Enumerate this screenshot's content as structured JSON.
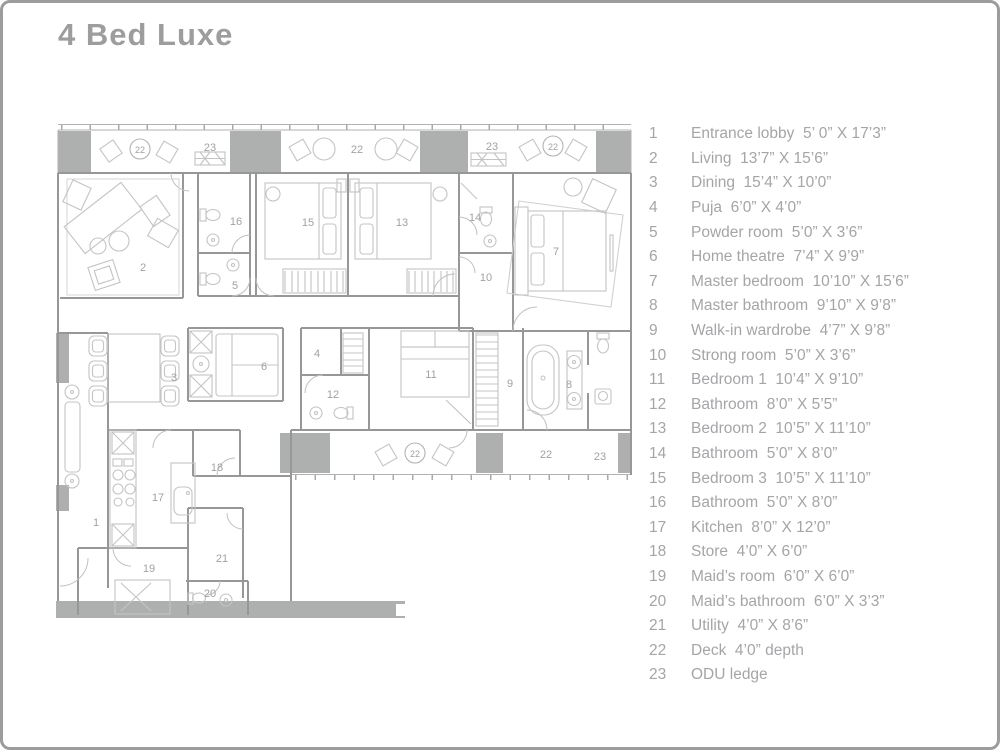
{
  "title": "4 Bed Luxe",
  "colors": {
    "title_gray": "#9d9d9d",
    "legend_text_gray": "#a5a5a8",
    "wall_gray": "#979797",
    "furniture_gray": "#c4c4c4",
    "dark_block_gray": "#aeb0b0",
    "border_gray": "#9c9c9c"
  },
  "legend": {
    "items": [
      {
        "num": "1",
        "label": "Entrance lobby  5’ 0” X 17’3”"
      },
      {
        "num": "2",
        "label": "Living  13’7” X 15’6”"
      },
      {
        "num": "3",
        "label": "Dining  15’4” X 10’0”"
      },
      {
        "num": "4",
        "label": "Puja  6’0” X 4’0”"
      },
      {
        "num": "5",
        "label": "Powder room  5’0” X 3’6”"
      },
      {
        "num": "6",
        "label": "Home theatre  7’4” X 9’9”"
      },
      {
        "num": "7",
        "label": "Master bedroom  10’10” X 15’6”"
      },
      {
        "num": "8",
        "label": "Master bathroom  9’10” X 9’8”"
      },
      {
        "num": "9",
        "label": "Walk-in wardrobe  4’7” X 9’8”"
      },
      {
        "num": "10",
        "label": "Strong room  5’0” X 3’6”"
      },
      {
        "num": "11",
        "label": "Bedroom 1  10’4” X 9’10”"
      },
      {
        "num": "12",
        "label": "Bathroom  8’0” X 5’5”"
      },
      {
        "num": "13",
        "label": "Bedroom 2  10’5” X 11’10”"
      },
      {
        "num": "14",
        "label": "Bathroom  5’0” X 8’0”"
      },
      {
        "num": "15",
        "label": "Bedroom 3  10’5” X 11’10”"
      },
      {
        "num": "16",
        "label": "Bathroom  5’0” X 8’0”"
      },
      {
        "num": "17",
        "label": "Kitchen  8’0” X 12’0”"
      },
      {
        "num": "18",
        "label": "Store  4’0” X 6’0”"
      },
      {
        "num": "19",
        "label": "Maid’s room  6’0” X 6’0”"
      },
      {
        "num": "20",
        "label": "Maid’s bathroom  6’0” X 3’3”"
      },
      {
        "num": "21",
        "label": "Utility  4’0” X 8’6”"
      },
      {
        "num": "22",
        "label": "Deck  4’0” depth"
      },
      {
        "num": "23",
        "label": "ODU ledge"
      }
    ]
  },
  "plan": {
    "labels": [
      "22",
      "23",
      "22",
      "23",
      "22",
      "2",
      "16",
      "5",
      "15",
      "13",
      "14",
      "10",
      "7",
      "3",
      "6",
      "4",
      "12",
      "11",
      "9",
      "8",
      "1",
      "17",
      "18",
      "21",
      "19",
      "20",
      "22",
      "22",
      "23"
    ]
  }
}
